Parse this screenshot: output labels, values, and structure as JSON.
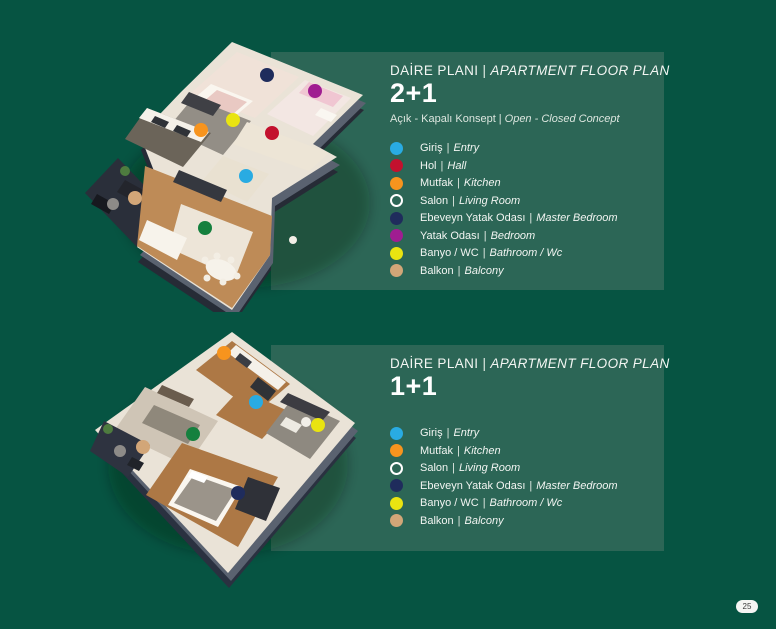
{
  "page": {
    "background": "#065442",
    "panel_background": "#2C6656",
    "page_number": "25"
  },
  "dot_colors": {
    "giris": "#29ABE2",
    "hol": "#C3112E",
    "mutfak": "#F7941E",
    "salon": "#15803E",
    "ebeveyn": "#1F2C5C",
    "yatak": "#A01D91",
    "banyo": "#E9E411",
    "balkon": "#D2A678"
  },
  "sections": [
    {
      "title_tr": "DAİRE PLANI",
      "separator": "|",
      "title_en": "APARTMENT FLOOR PLAN",
      "plan_type": "2+1",
      "subtitle_tr": "Açık - Kapalı Konsept",
      "subtitle_en": "Open - Closed Concept",
      "legend": [
        {
          "room": "giris",
          "tr": "Giriş",
          "en": "Entry"
        },
        {
          "room": "hol",
          "tr": "Hol",
          "en": "Hall"
        },
        {
          "room": "mutfak",
          "tr": "Mutfak",
          "en": "Kitchen"
        },
        {
          "room": "salon",
          "tr": "Salon",
          "en": "Living Room",
          "ring": true
        },
        {
          "room": "ebeveyn",
          "tr": "Ebeveyn Yatak Odası",
          "en": "Master Bedroom"
        },
        {
          "room": "yatak",
          "tr": "Yatak Odası",
          "en": "Bedroom"
        },
        {
          "room": "banyo",
          "tr": "Banyo / WC",
          "en": "Bathroom / Wc"
        },
        {
          "room": "balkon",
          "tr": "Balkon",
          "en": "Balcony"
        }
      ]
    },
    {
      "title_tr": "DAİRE PLANI",
      "separator": "|",
      "title_en": "APARTMENT FLOOR PLAN",
      "plan_type": "1+1",
      "legend": [
        {
          "room": "giris",
          "tr": "Giriş",
          "en": "Entry"
        },
        {
          "room": "mutfak",
          "tr": "Mutfak",
          "en": "Kitchen"
        },
        {
          "room": "salon",
          "tr": "Salon",
          "en": "Living Room",
          "ring": true
        },
        {
          "room": "ebeveyn",
          "tr": "Ebeveyn Yatak Odası",
          "en": "Master Bedroom"
        },
        {
          "room": "banyo",
          "tr": "Banyo / WC",
          "en": "Bathroom / Wc"
        },
        {
          "room": "balkon",
          "tr": "Balkon",
          "en": "Balcony"
        }
      ]
    }
  ]
}
